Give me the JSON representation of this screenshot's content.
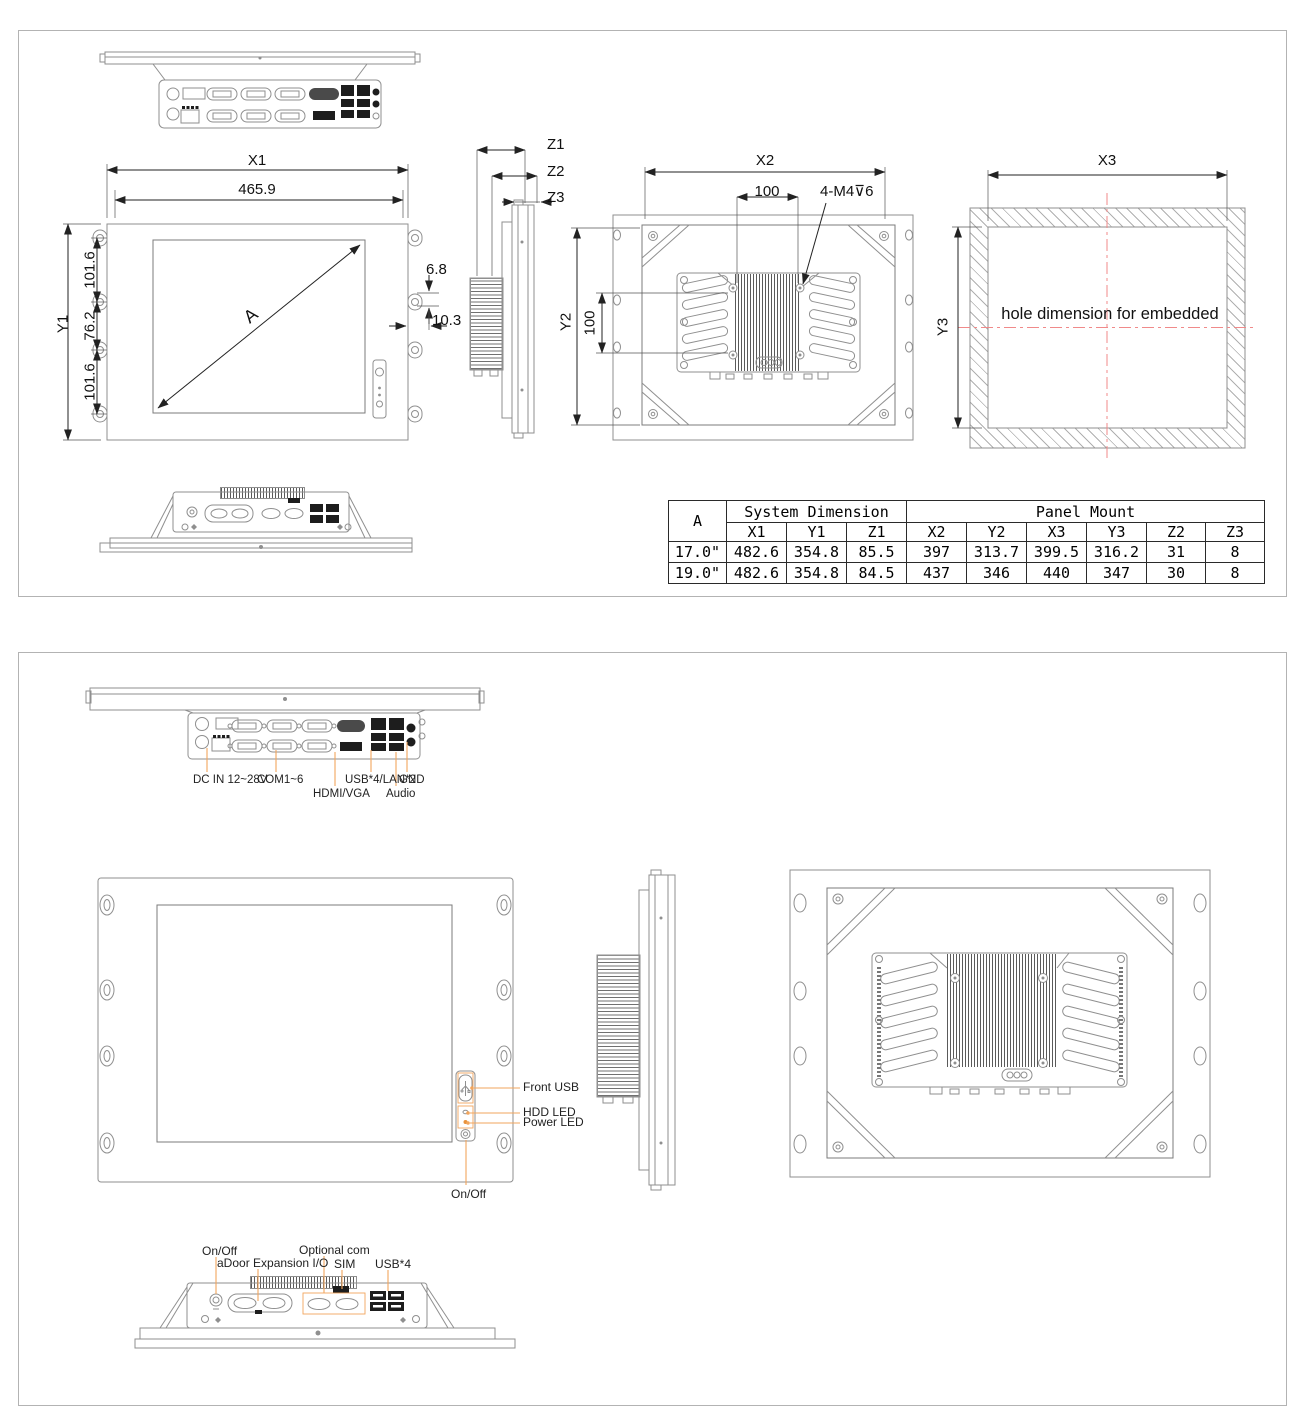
{
  "panel1": {
    "front": {
      "x1": "X1",
      "x1_value": "465.9",
      "y1": "Y1",
      "seg_top": "101.6",
      "seg_mid": "76.2",
      "seg_bot": "101.6",
      "diagonal": "A",
      "hook_offset": "6.8",
      "hook_depth": "10.3"
    },
    "side": {
      "z1": "Z1",
      "z2": "Z2",
      "z3": "Z3"
    },
    "rear": {
      "x2": "X2",
      "pitch_h": "100",
      "screws": "4-M4⊽6",
      "y2": "Y2",
      "pitch_v": "100"
    },
    "hole": {
      "x3": "X3",
      "y3": "Y3",
      "note": "hole dimension for embedded"
    },
    "table": {
      "col_a": "A",
      "group_system": "System Dimension",
      "group_panel": "Panel Mount",
      "cols": [
        "X1",
        "Y1",
        "Z1",
        "X2",
        "Y2",
        "X3",
        "Y3",
        "Z2",
        "Z3"
      ],
      "rows": [
        {
          "a": "17.0\"",
          "v": [
            "482.6",
            "354.8",
            "85.5",
            "397",
            "313.7",
            "399.5",
            "316.2",
            "31",
            "8"
          ]
        },
        {
          "a": "19.0\"",
          "v": [
            "482.6",
            "354.8",
            "84.5",
            "437",
            "346",
            "440",
            "347",
            "30",
            "8"
          ]
        }
      ]
    }
  },
  "panel2": {
    "io": {
      "dc": "DC IN 12~28V",
      "com": "COM1~6",
      "hdmi": "HDMI/VGA",
      "usb_lan": "USB*4/LAN*2",
      "audio": "Audio",
      "gnd": "GND"
    },
    "front": {
      "front_usb": "Front USB",
      "hdd_led": "HDD LED",
      "power_led": "Power LED",
      "on_off": "On/Off"
    },
    "bottom": {
      "on_off": "On/Off",
      "adoor": "aDoor Expansion I/O",
      "optional_com": "Optional com",
      "sim": "SIM",
      "usb4": "USB*4"
    }
  },
  "colors": {
    "part_line": "#8f8f8f",
    "dim_line": "#222222",
    "leader": "#f2a55c",
    "centerline": "#f08a8a",
    "power_led": "#e8923c"
  }
}
